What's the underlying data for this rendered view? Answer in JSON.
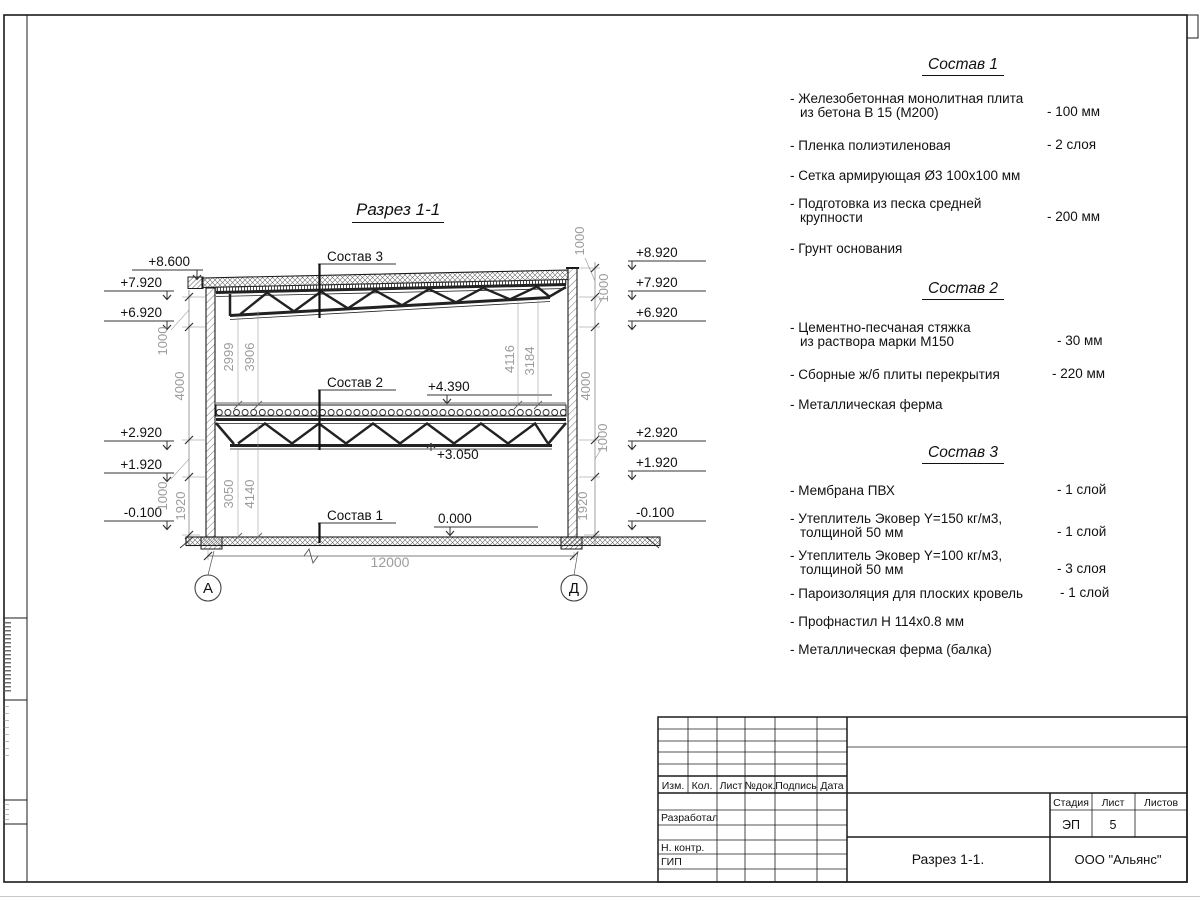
{
  "drawing_title": "Разрез 1-1",
  "section": {
    "sostav_labels": [
      "Состав 3",
      "Состав 2",
      "Состав 1"
    ],
    "levels_left": [
      "+8.600",
      "+7.920",
      "+6.920",
      "+2.920",
      "+1.920",
      "-0.100"
    ],
    "levels_right": [
      "+8.920",
      "+7.920",
      "+6.920",
      "+2.920",
      "+1.920",
      "-0.100"
    ],
    "marks": {
      "floor2": "+4.390",
      "truss2": "+3.050",
      "floor1": "0.000"
    },
    "dims": {
      "span": "12000",
      "left_chain": [
        "1000",
        "4000",
        "1000",
        "1920"
      ],
      "right_chain": [
        "1000",
        "1000",
        "4000",
        "1000",
        "1920"
      ],
      "upper_left": [
        "2999",
        "3906"
      ],
      "upper_right": [
        "4116",
        "3184"
      ],
      "lower": [
        "3050",
        "4140"
      ]
    },
    "axes": [
      "А",
      "Д"
    ]
  },
  "compositions": [
    {
      "title": "Состав 1",
      "items": [
        {
          "l1": "- Железобетонная  монолитная плита",
          "l2": "из бетона В 15 (М200)",
          "v": "- 100 мм"
        },
        {
          "l1": "- Пленка полиэтиленовая",
          "v": "-  2 слоя"
        },
        {
          "l1": "- Сетка армирующая Ø3 100х100 мм"
        },
        {
          "l1": "- Подготовка из песка средней",
          "l2": "крупности",
          "v": "- 200 мм"
        },
        {
          "l1": "- Грунт основания"
        }
      ]
    },
    {
      "title": "Состав 2",
      "items": [
        {
          "l1": "- Цементно-песчаная стяжка",
          "l2": "из раствора марки М150",
          "v": "- 30 мм"
        },
        {
          "l1": "- Сборные ж/б плиты перекрытия",
          "v": "- 220 мм"
        },
        {
          "l1": "- Металлическая ферма"
        }
      ]
    },
    {
      "title": "Состав 3",
      "items": [
        {
          "l1": "- Мембрана ПВХ",
          "v": "- 1 слой"
        },
        {
          "l1": "- Утеплитель Эковер Y=150 кг/м3,",
          "l2": "толщиной 50 мм",
          "v": "- 1 слой"
        },
        {
          "l1": "- Утеплитель Эковер Y=100 кг/м3,",
          "l2": "толщиной 50 мм",
          "v": "- 3 слоя"
        },
        {
          "l1": "- Пароизоляция для плоских кровель",
          "v": "- 1 слой"
        },
        {
          "l1": "- Профнастил Н 114х0.8 мм"
        },
        {
          "l1": "- Металлическая ферма (балка)"
        }
      ]
    }
  ],
  "title_block": {
    "header_cols": [
      "Изм.",
      "Кол.",
      "Лист",
      "№док.",
      "Подпись",
      "Дата"
    ],
    "row_labels": [
      "Разработал",
      "Н. контр.",
      "ГИП"
    ],
    "stage_label": "Стадия",
    "sheet_label": "Лист",
    "sheets_label": "Листов",
    "stage_value": "ЭП",
    "sheet_value": "5",
    "doc_title": "Разрез  1-1.",
    "company": "ООО \"Альянс\""
  },
  "colors": {
    "line": "#1b1b1b",
    "dim_text": "#9c9c9c",
    "paper": "#ffffff"
  }
}
